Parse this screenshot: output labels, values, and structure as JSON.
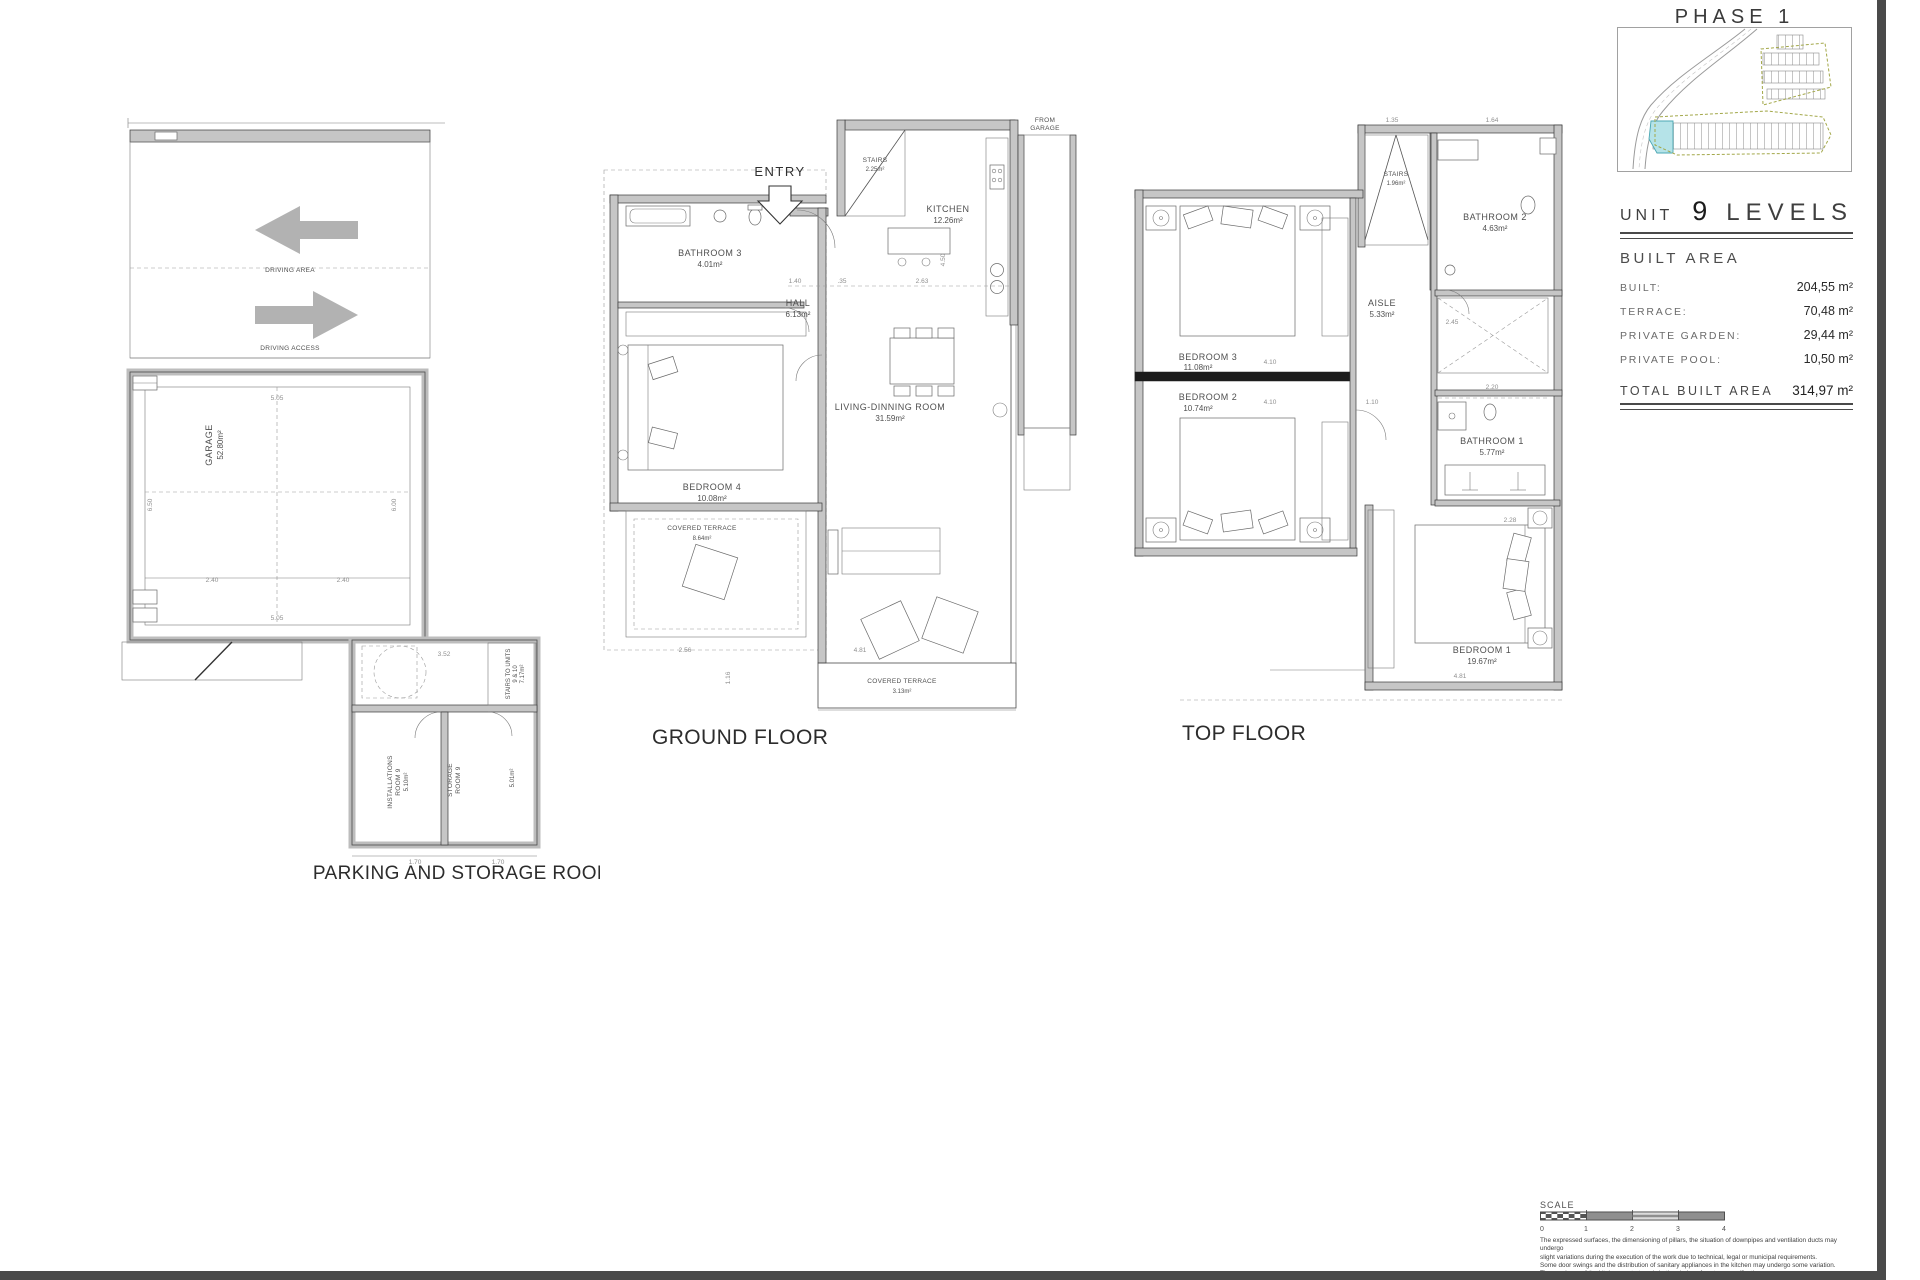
{
  "page": {
    "phase_title": "PHASE 1",
    "unit_header": {
      "unit_word": "UNIT",
      "unit_number": "9",
      "levels_word": "LEVELS"
    },
    "built_area": {
      "heading": "BUILT AREA",
      "rows": [
        {
          "label": "BUILT:",
          "value": "204,55 m²"
        },
        {
          "label": "TERRACE:",
          "value": "70,48 m²"
        },
        {
          "label": "PRIVATE GARDEN:",
          "value": "29,44 m²"
        },
        {
          "label": "PRIVATE POOL:",
          "value": "10,50 m²"
        }
      ],
      "total_label": "TOTAL BUILT AREA",
      "total_value": "314,97 m²"
    }
  },
  "parking_plan": {
    "title": "PARKING AND STORAGE ROOM",
    "driving_area": "DRIVING AREA",
    "driving_access": "DRIVING ACCESS",
    "garage": {
      "name": "GARAGE",
      "area": "52.80m²"
    },
    "installations": {
      "line1": "INSTALLATIONS",
      "line2": "ROOM 9",
      "area": "5.10m²"
    },
    "storage": {
      "line1": "STORAGE",
      "line2": "ROOM 9",
      "area": "5.01m²"
    },
    "stairs_units": {
      "line1": "STAIRS TO UNITS",
      "line2": "9 & 10",
      "area": "7.17m²"
    },
    "dims": [
      "5.05",
      "6.50",
      "6.00",
      "2.40",
      "2.40",
      "5.05",
      "3.52",
      "1.70",
      "1.70"
    ]
  },
  "ground_floor": {
    "title": "GROUND FLOOR",
    "entry": "ENTRY",
    "stairs": {
      "name": "STAIRS",
      "area": "2.25m²"
    },
    "kitchen": {
      "name": "KITCHEN",
      "area": "12.26m²"
    },
    "from_garage": {
      "line1": "FROM",
      "line2": "GARAGE"
    },
    "hall": {
      "name": "HALL",
      "area": "6.13m²"
    },
    "bathroom3": {
      "name": "BATHROOM 3",
      "area": "4.01m²"
    },
    "bedroom4": {
      "name": "BEDROOM 4",
      "area": "10.08m²"
    },
    "living": {
      "name": "LIVING-DINNING ROOM",
      "area": "31.59m²"
    },
    "terrace_side": {
      "name": "COVERED TERRACE",
      "area": "8.64m²"
    },
    "terrace_bottom": {
      "name": "COVERED TERRACE",
      "area": "3.13m²"
    },
    "dims": [
      "1.40",
      ".35",
      "2.63",
      "4.50",
      "2.56",
      "1.16",
      "4.81"
    ]
  },
  "top_floor": {
    "title": "TOP FLOOR",
    "stairs": {
      "name": "STAIRS",
      "area": "1.96m²"
    },
    "bathroom2": {
      "name": "BATHROOM 2",
      "area": "4.63m²"
    },
    "aisle": {
      "name": "AISLE",
      "area": "5.33m²"
    },
    "bedroom3": {
      "name": "BEDROOM 3",
      "area": "11.08m²"
    },
    "bedroom2": {
      "name": "BEDROOM 2",
      "area": "10.74m²"
    },
    "bathroom1": {
      "name": "BATHROOM 1",
      "area": "5.77m²"
    },
    "bedroom1": {
      "name": "BEDROOM 1",
      "area": "19.67m²"
    },
    "dims": [
      "4.10",
      "4.10",
      "1.10",
      "2.45",
      "2.20",
      "2.28",
      "4.81",
      "1.64",
      "1.35"
    ]
  },
  "scale_bar": {
    "label": "SCALE",
    "ticks": [
      "0",
      "1",
      "2",
      "3",
      "4"
    ]
  },
  "disclaimer": {
    "lines": [
      "The expressed surfaces, the dimensioning of pillars, the situation of downpipes and ventilation ducts may undergo",
      "slight variations during the execution of the work due to technical, legal or municipal requirements.",
      "Some door swings and the distribution of sanitary appliances in the kitchen may undergo some variation.",
      "The overhang of the kitchen centertops is in the choice of custom specifications.",
      "The furniture is merely informative and the materials list will be those represented in the specifications."
    ]
  }
}
